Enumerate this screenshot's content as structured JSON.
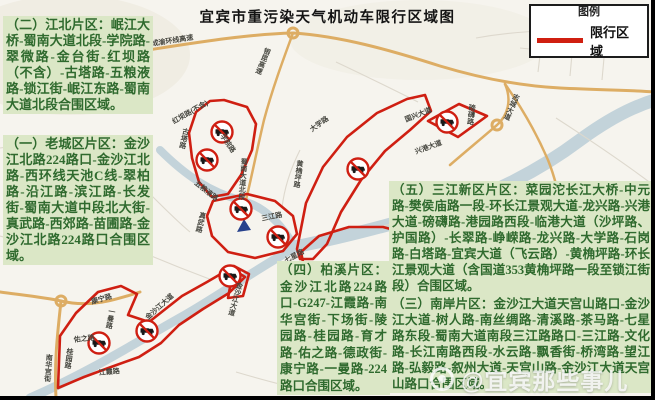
{
  "title": "宜宾市重污染天气机动车限行区域图",
  "legend": {
    "heading": "图例",
    "item": "限行区域"
  },
  "blocks": {
    "jiangbei": "（二）江北片区：岷江大桥-蜀南大道北段-学院路-翠微路-金台街-红坝路（不含）-古塔路-五粮液路-锁江街-岷江东路-蜀南大道北段合围区域。",
    "laocheng": "（一）老城区片区：金沙江北路224路口-金沙江北路-西环线天池C线-翠柏路-沿江路-滨江路-长发街-蜀南大道中段北大街-真武路-西郊路-苗圃路-金沙江北路224路口合围区域。",
    "baixi": "（四）柏溪片区：金沙江北路224路口-G247-江霞路-南华宫街-下场街-陵园路-桂园路-育才路-佑之路-德政街-康宁路-一曼路-224路口合围区域。",
    "sanjiang": "（五）三江新区片区：菜园沱长江大桥-中元路-樊侯庙路一段-环长江景观大道-龙兴路-兴港大道-磅礴路-港园路西段-临港大道（沙坪路、护国路）-长翠路-峥嵘路-龙兴路-大学路-石岗路-白塔路-宜宾大道（飞云路）-黄桷坪路-环长江景观大道（含国道353黄桷坪路一段至锁江街段）合围区域。",
    "nanan": "（三）南岸片区：金沙江大道天宫山路口-金沙江大道-树人路-南丝绸路-清溪路-茶马路-七星路东段-蜀南大道南段三江路路口-三江路-文化路-长江南路西段-水云路-飘香街-桥湾路-望江路-弘毅路-叙州大道-天宫山路-金沙江大道天宫山路口合围区域。"
  },
  "watermark": "@宜宾那些事儿",
  "colors": {
    "zone": "#cf1f12",
    "block_bg": "#dbe7c6",
    "block_text": "#2f6a2e",
    "highway": "#ddad64",
    "river": "#c3d3da",
    "legend_line": "#d01f10"
  },
  "map": {
    "labels": [
      {
        "t": "成渝环线高速",
        "x": 152,
        "y": 46,
        "r": -9
      },
      {
        "t": "银昆高速",
        "x": 268,
        "y": 48,
        "r": 22,
        "v": 1
      },
      {
        "t": "安白路",
        "x": 141,
        "y": 66,
        "r": 6,
        "v": 1
      },
      {
        "t": "红坝路(不含)",
        "x": 174,
        "y": 124,
        "r": -30
      },
      {
        "t": "古塔路",
        "x": 186,
        "y": 128,
        "r": 12,
        "v": 1
      },
      {
        "t": "学院路",
        "x": 220,
        "y": 136,
        "r": 55
      },
      {
        "t": "蜀南大道北段",
        "x": 244,
        "y": 158,
        "r": 4,
        "v": 1
      },
      {
        "t": "五粮液路",
        "x": 194,
        "y": 184,
        "r": 38
      },
      {
        "t": "大学路",
        "x": 312,
        "y": 132,
        "r": -36
      },
      {
        "t": "黄桷坪路",
        "x": 300,
        "y": 160,
        "r": 8,
        "v": 1
      },
      {
        "t": "三江路",
        "x": 262,
        "y": 221,
        "r": -12
      },
      {
        "t": "真武路",
        "x": 203,
        "y": 212,
        "r": 14,
        "v": 1
      },
      {
        "t": "金沙江大道",
        "x": 240,
        "y": 282,
        "r": 16,
        "v": 1
      },
      {
        "t": "金沙江大道",
        "x": 148,
        "y": 320,
        "r": -42
      },
      {
        "t": "七星路",
        "x": 286,
        "y": 263,
        "r": -28
      },
      {
        "t": "康宁路",
        "x": 92,
        "y": 304,
        "r": -16
      },
      {
        "t": "一曼路",
        "x": 112,
        "y": 308,
        "r": 10,
        "v": 1
      },
      {
        "t": "佑之路",
        "x": 74,
        "y": 342,
        "r": -6
      },
      {
        "t": "桂园路",
        "x": 70,
        "y": 348,
        "r": 8,
        "v": 1
      },
      {
        "t": "南华宫街",
        "x": 49,
        "y": 354,
        "r": 4,
        "v": 1
      },
      {
        "t": "江霞路",
        "x": 99,
        "y": 375,
        "r": -5
      },
      {
        "t": "国兴大道",
        "x": 406,
        "y": 122,
        "r": -22
      },
      {
        "t": "兴港大道",
        "x": 416,
        "y": 154,
        "r": -20
      },
      {
        "t": "磅礴路",
        "x": 472,
        "y": 104,
        "r": 6,
        "v": 1
      },
      {
        "t": "志城大道",
        "x": 517,
        "y": 94,
        "r": 24,
        "v": 1
      }
    ],
    "no_entry_signs": [
      {
        "x": 222,
        "y": 132
      },
      {
        "x": 207,
        "y": 160
      },
      {
        "x": 241,
        "y": 209
      },
      {
        "x": 278,
        "y": 237
      },
      {
        "x": 358,
        "y": 169
      },
      {
        "x": 447,
        "y": 122
      },
      {
        "x": 230,
        "y": 276
      },
      {
        "x": 147,
        "y": 331
      },
      {
        "x": 99,
        "y": 343
      }
    ]
  }
}
